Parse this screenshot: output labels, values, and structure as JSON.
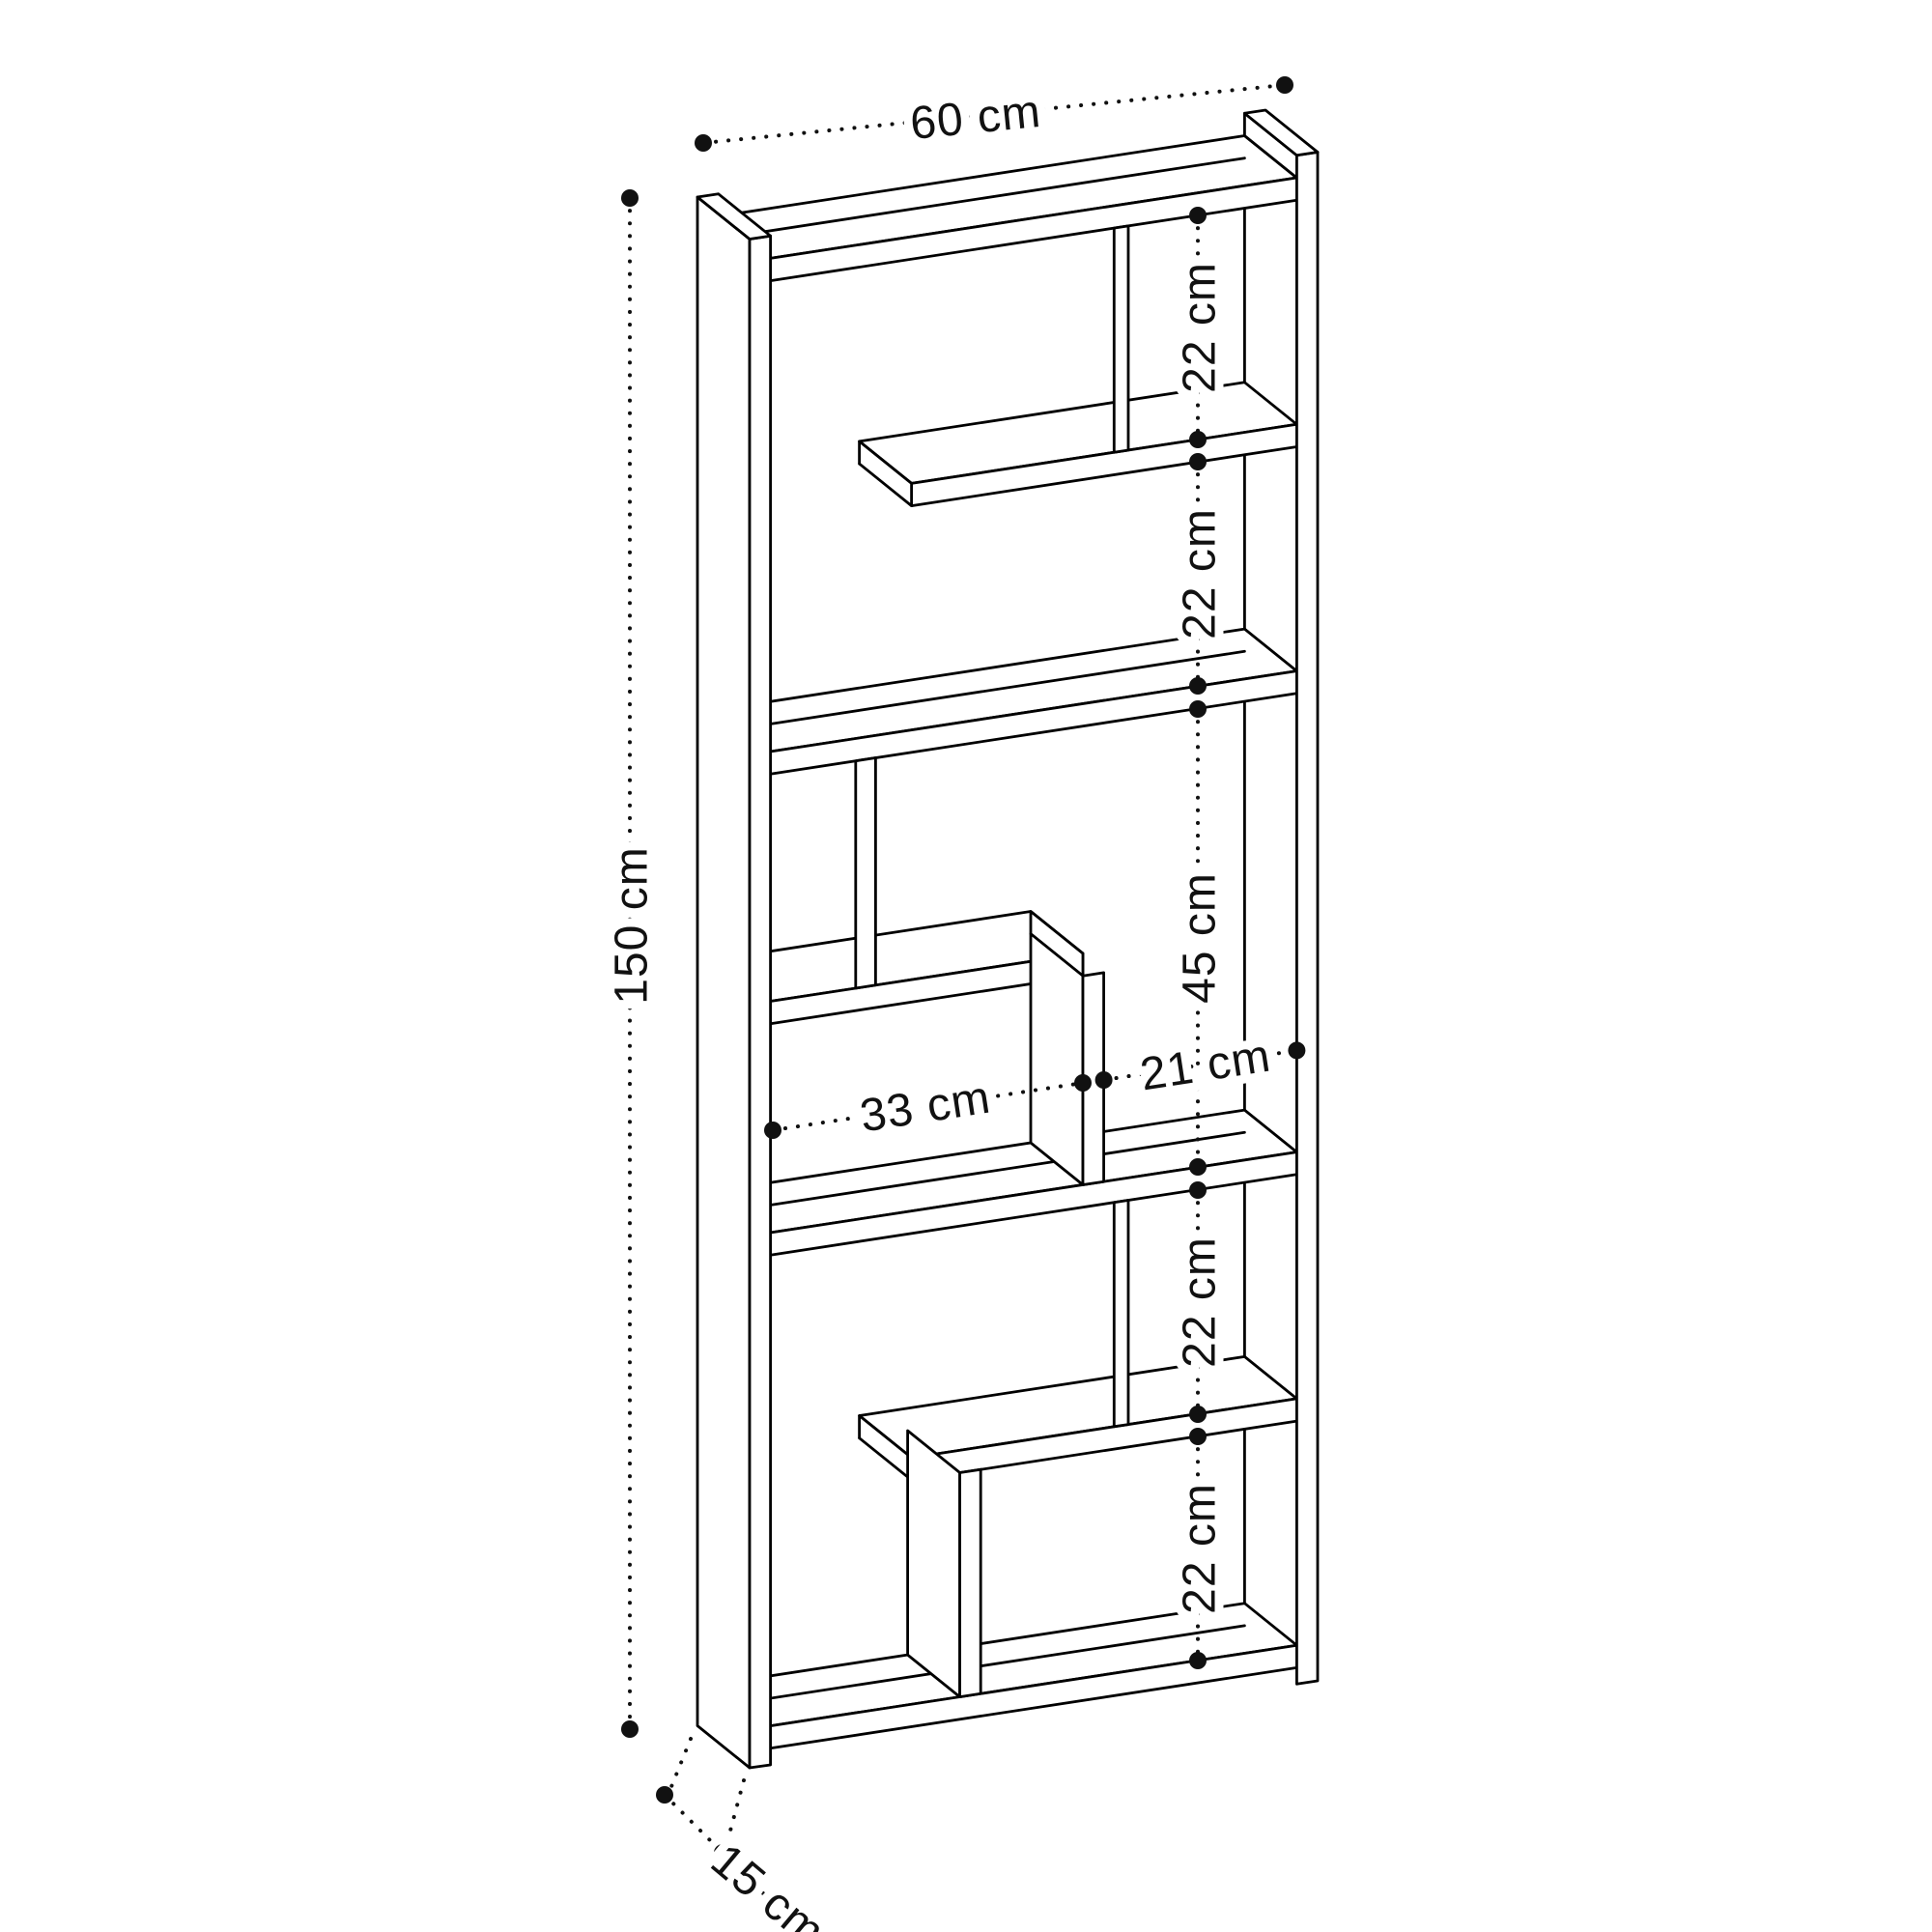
{
  "page": {
    "title": "Bookcase dimension drawing",
    "background": "#ffffff"
  },
  "drawing": {
    "item": "zigzag-bookcase",
    "style": {
      "line_color": "#000000",
      "text_color": "#111111",
      "background": "#ffffff"
    },
    "overall": {
      "width": {
        "label": "60 cm"
      },
      "height": {
        "label": "150 cm"
      },
      "depth": {
        "label": "15 cm"
      }
    },
    "section_heights": [
      {
        "id": "top",
        "label": "22 cm"
      },
      {
        "id": "upper-middle",
        "label": "22 cm"
      },
      {
        "id": "middle",
        "label": "45 cm"
      },
      {
        "id": "lower-middle",
        "label": "22 cm"
      },
      {
        "id": "bottom",
        "label": "22 cm"
      }
    ],
    "compartment_widths": [
      {
        "id": "left",
        "label": "33 cm"
      },
      {
        "id": "right",
        "label": "21 cm"
      }
    ]
  }
}
